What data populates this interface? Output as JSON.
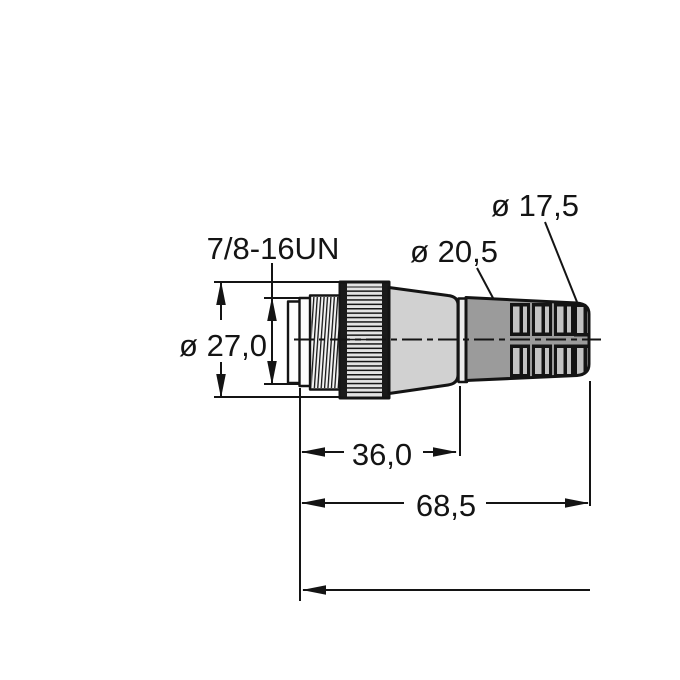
{
  "drawing": {
    "labels": {
      "thread_spec": "7/8-16UN",
      "nut_diameter": "ø 27,0",
      "body_diameter": "ø 20,5",
      "grip_end_diameter": "ø 17,5",
      "front_length": "36,0",
      "overall_length": "68,5"
    },
    "colors": {
      "ink": "#141414",
      "connector_body": "#d1d1d1",
      "grip": "#9b9b9b",
      "grip_slot": "#c3c3c3",
      "nut": "#e3e3e3",
      "nut_edge": "#1a1a1a",
      "thread": "#f3f3f3",
      "neck": "#ececec",
      "flange": "#fdfdfd",
      "background": "#ffffff"
    }
  }
}
